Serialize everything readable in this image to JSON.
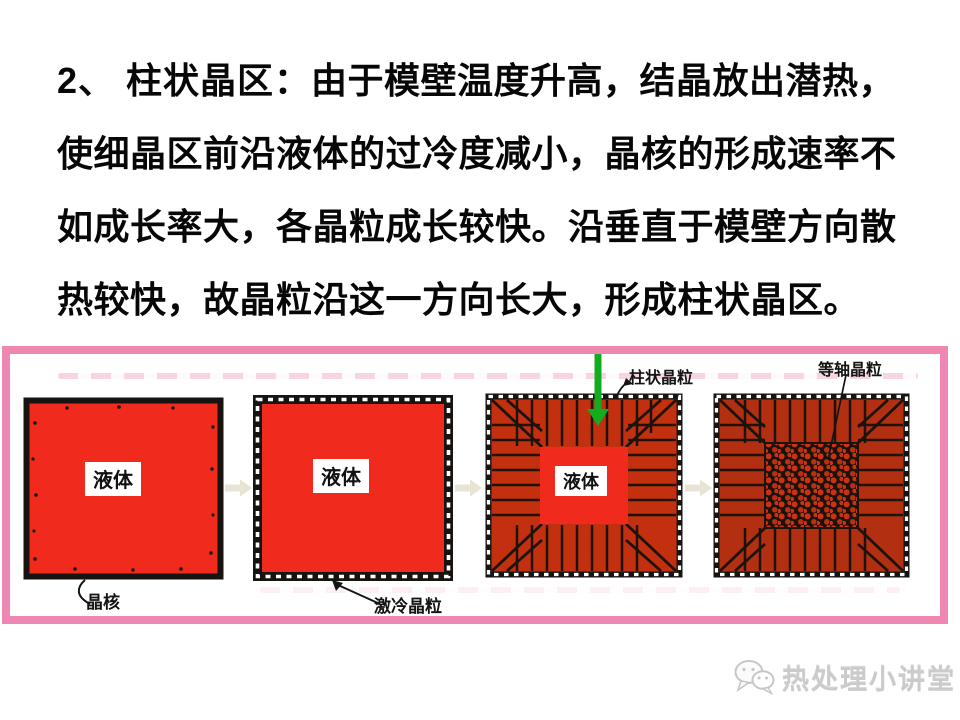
{
  "paragraph": {
    "lead": "2、  柱状晶区：",
    "line1_rest": "由于模壁温度升高，结晶放出潜热，",
    "line2": "使细晶区前沿液体的过冷度减小，晶核的形成速率不",
    "line3": "如成长率大，各晶粒成长较快。沿垂直于模壁方向散",
    "line4": "热较快，故晶粒沿这一方向长大，形成柱状晶区。"
  },
  "figure": {
    "stages": [
      {
        "liquid_label": "液体",
        "annotation": "晶核"
      },
      {
        "liquid_label": "液体",
        "annotation": "激冷晶粒"
      },
      {
        "liquid_label": "液体",
        "annotation": "柱状晶粒"
      },
      {
        "annotation": "等轴晶粒"
      }
    ],
    "colors": {
      "frame_pink": "#ee88b3",
      "liquid_red": "#f02a1c",
      "columnar_red": "#c23010",
      "equiaxed_red": "#b23011",
      "grain_line_black": "#1d130a",
      "flow_arrow_beige": "#e8e4d4",
      "green_arrow": "#12ac20"
    }
  },
  "watermark": {
    "text": "热处理小讲堂",
    "icon": "wechat-icon"
  }
}
